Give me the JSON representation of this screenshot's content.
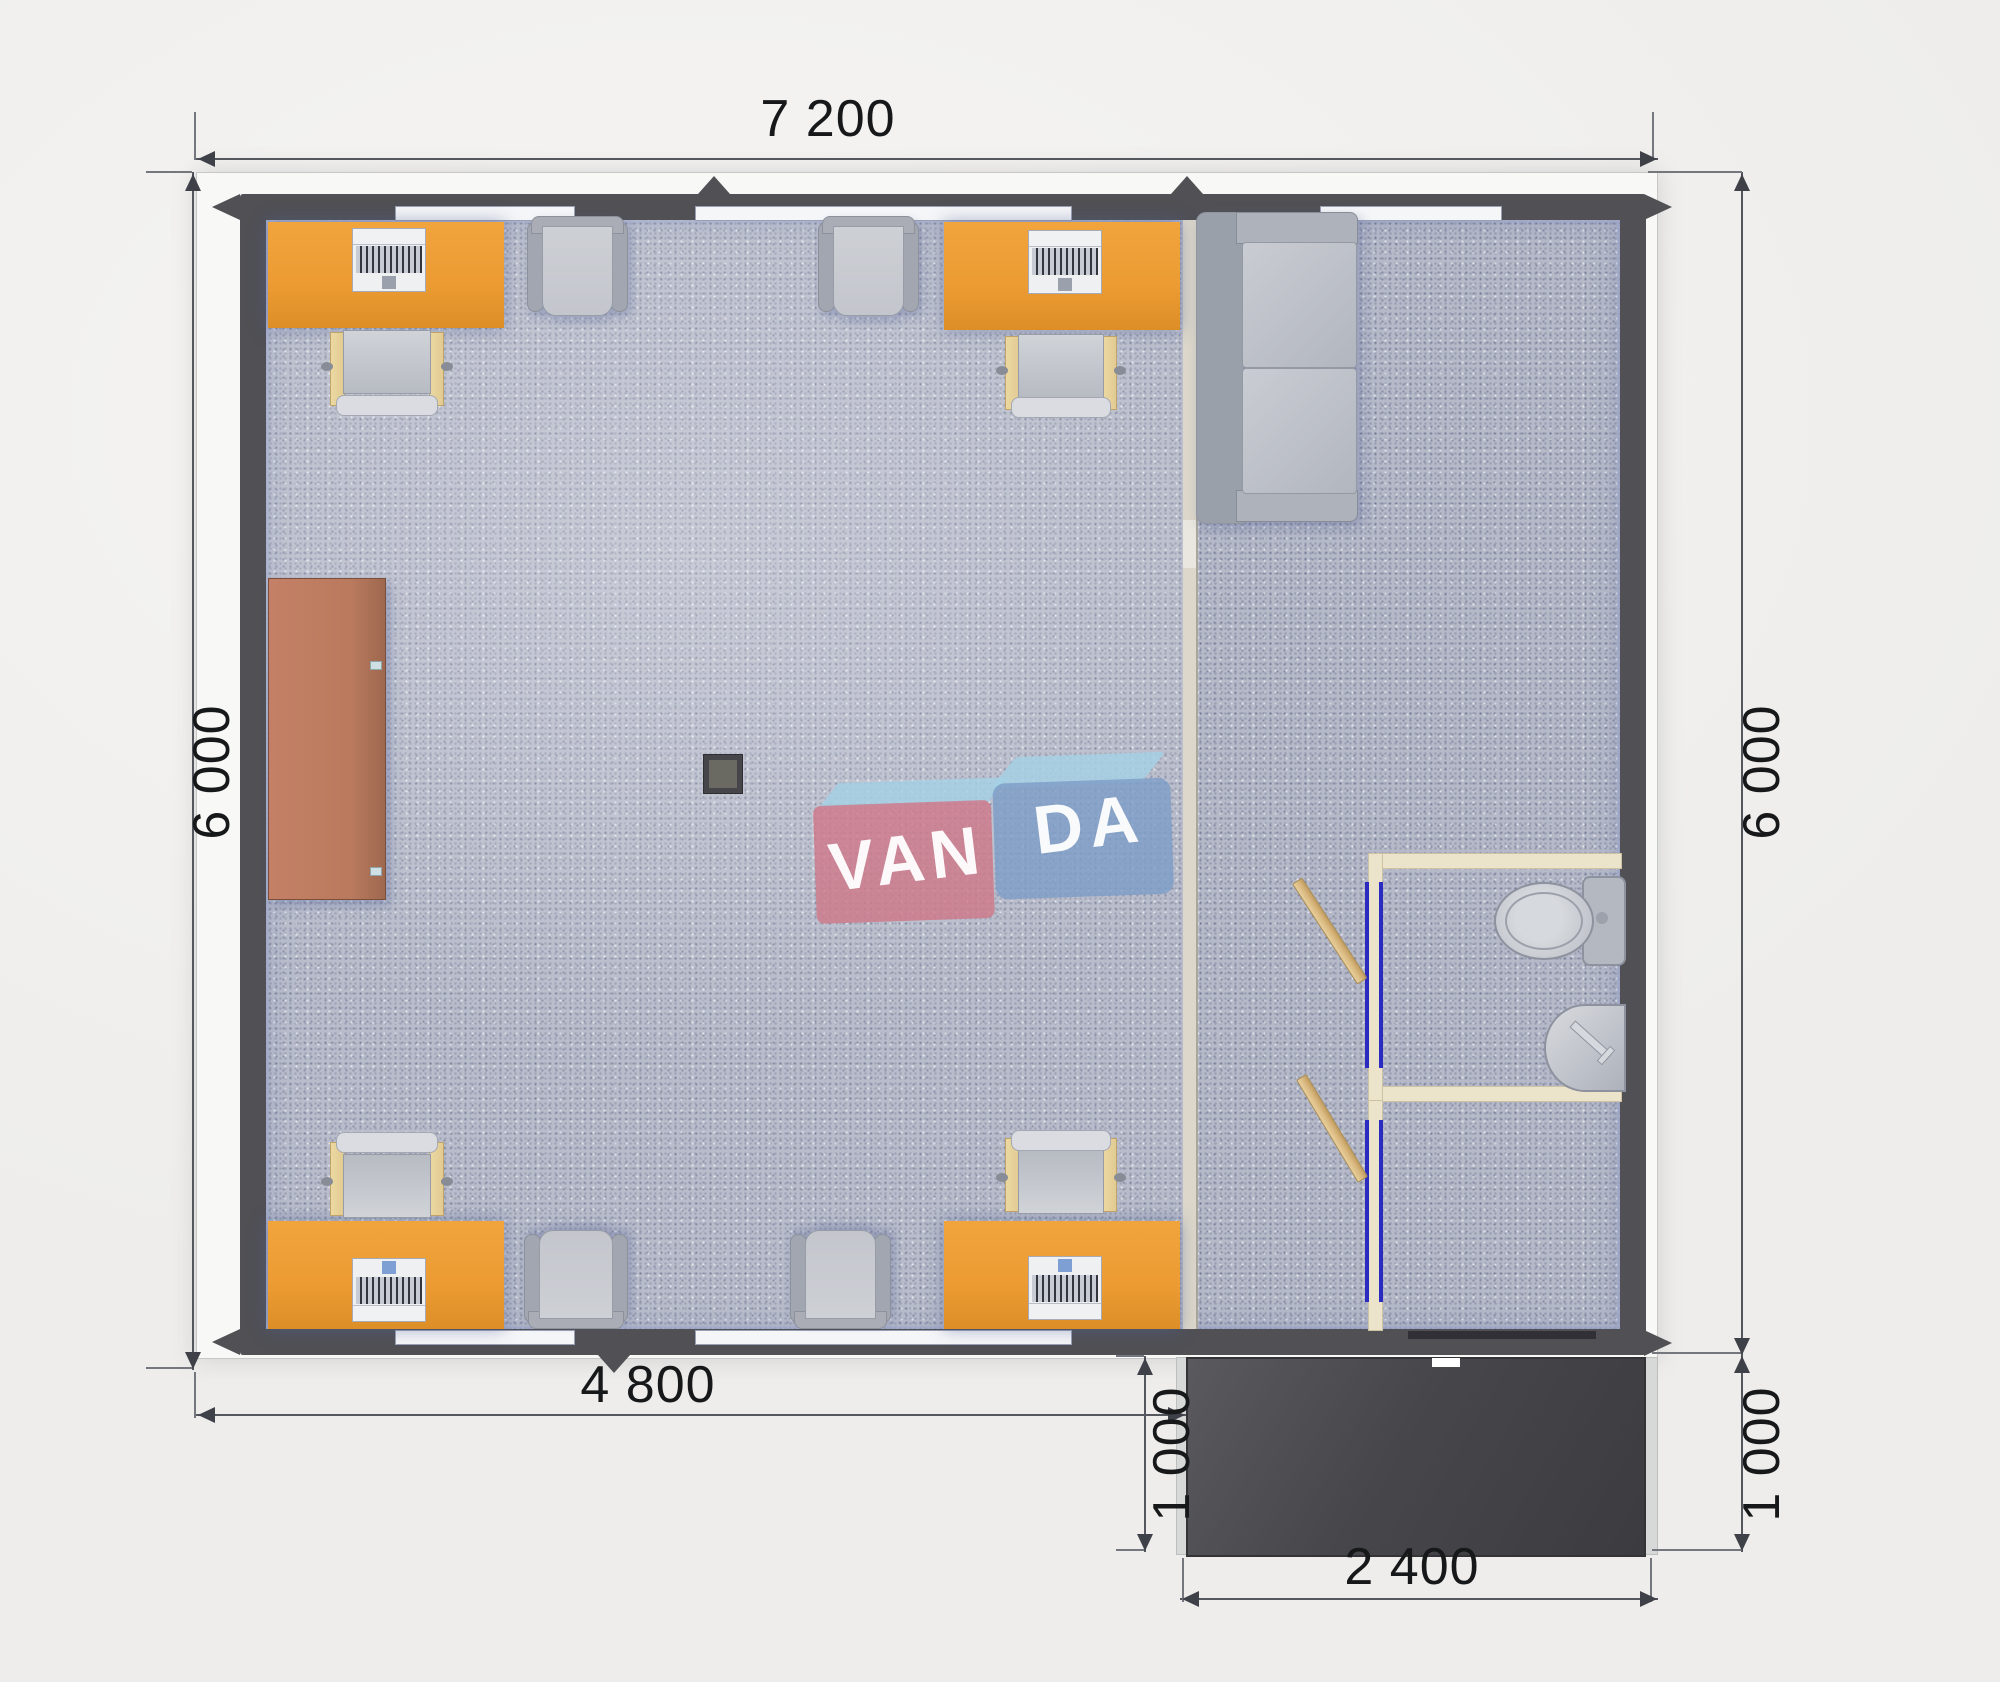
{
  "plan": {
    "watermark": {
      "part1": "VAN",
      "part2": "DA"
    },
    "dimensions": {
      "top_width": "7 200",
      "left_height": "6 000",
      "right_height": "6 000",
      "office_width": "4 800",
      "porch_depth_left": "1 000",
      "porch_depth_right": "1 000",
      "porch_width": "2 400"
    }
  },
  "colors": {
    "bg": "#f1f0ee",
    "trim": "#f8f8f6",
    "wall": "#505055",
    "carpet": "#b5b9c8",
    "partition": "#dcd7ca",
    "desk": "#eb9b32",
    "chair_wood": "#e2cb92",
    "furniture_gray": "#a2a6b0",
    "cushion_gray": "#c3c6cc",
    "cabinet": "#ba7a5e",
    "bath_wall": "#ece3cb",
    "door_frame": "#2b2bc2",
    "door_leaf": "#d9b87f",
    "porch": "#4a4a4e",
    "window": "#f5f6f8",
    "column": "#45454a",
    "dim_line": "#54575d",
    "dim_text": "#17181a",
    "logo_pink": "#cf7a8b",
    "logo_blue": "#7e9dc7",
    "logo_blue_light": "#a6d0e4",
    "logo_text": "#ffffff"
  }
}
